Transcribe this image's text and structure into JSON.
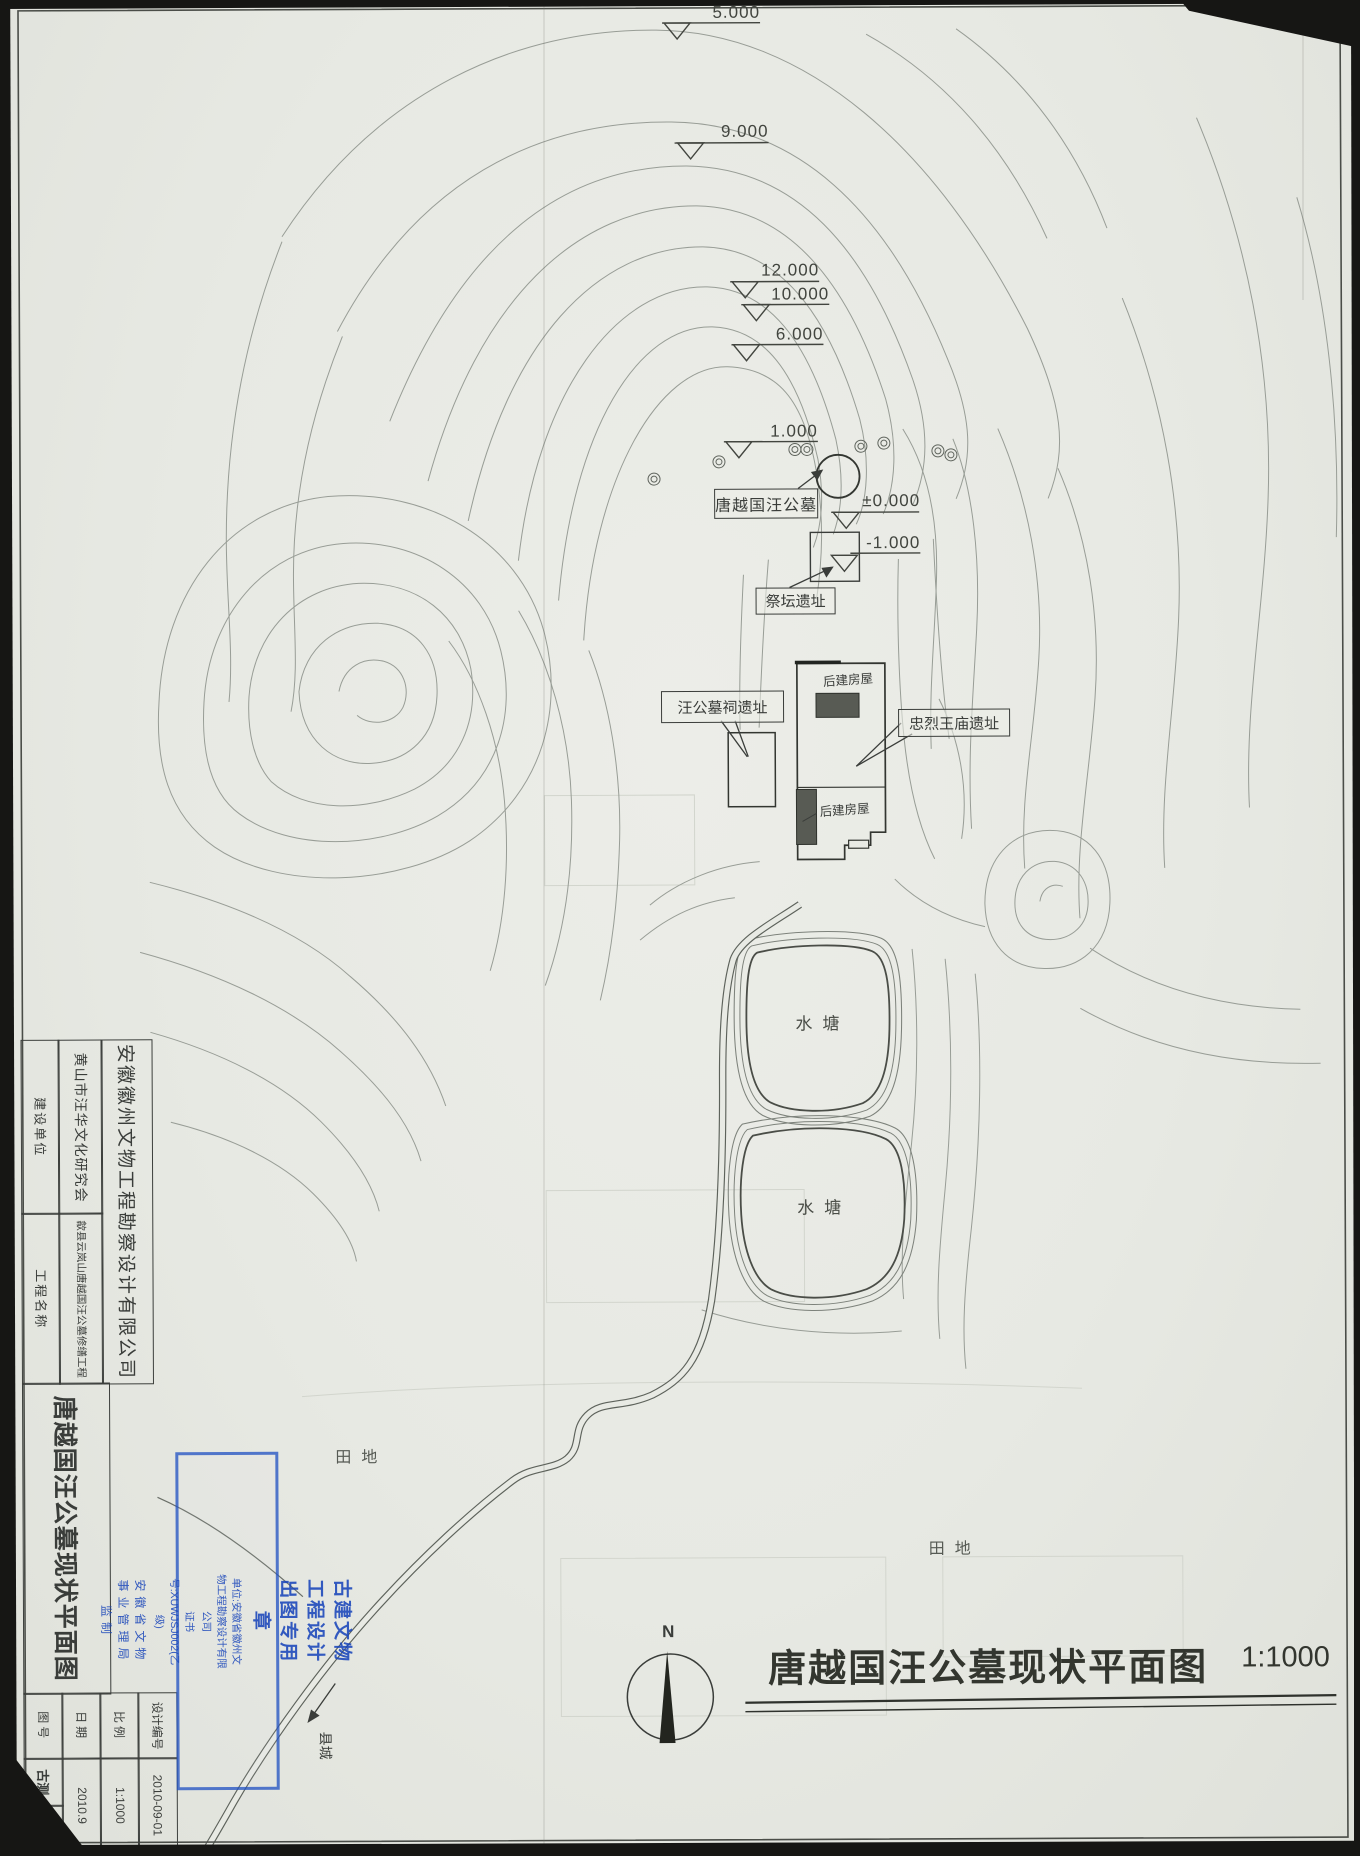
{
  "map": {
    "elevations": [
      "5.000",
      "9.000",
      "12.000",
      "10.000",
      "6.000",
      "1.000",
      "±0.000",
      "-1.000"
    ],
    "labels": {
      "tomb": "唐越国汪公墓",
      "altar_site": "祭坛遗址",
      "shrine_site": "汪公墓祠遗址",
      "temple_site": "忠烈王庙遗址",
      "later_house_upper": "后建房屋",
      "later_house_lower": "后建房屋",
      "pond_upper": "水塘",
      "pond_lower": "水塘",
      "field_west": "田地",
      "field_east": "田地",
      "county_town": "县城"
    },
    "north_label": "N",
    "caption_title": "唐越国汪公墓现状平面图",
    "caption_scale": "1:1000"
  },
  "title_block": {
    "company": "安徽徽州文物工程勘察设计有限公司",
    "owner_label": "建设单位",
    "owner_value": "黄山市汪华文化研究会",
    "project_label": "工程名称",
    "project_value": "歙县云岚山唐越国汪公墓修缮工程",
    "drawing_name": "唐越国汪公墓现状平面图",
    "design_no_label": "设计编号",
    "design_no_value": "2010-09-01",
    "scale_label": "比例",
    "scale_value": "1:1000",
    "date_label": "日期",
    "date_value": "2010.9",
    "sheet_no_label": "图号",
    "sheet_no_value": "古测",
    "sheet_no_extra": "2"
  },
  "stamp": {
    "title": "古建文物工程设计出图专用章",
    "unit": "单位:安徽省徽州文物工程勘察设计有限公司",
    "cert": "证书号:XUWJSJ002(乙级)",
    "issuer": "安徽省文物事业管理局监制",
    "ink_color": "#1e4fc2"
  }
}
